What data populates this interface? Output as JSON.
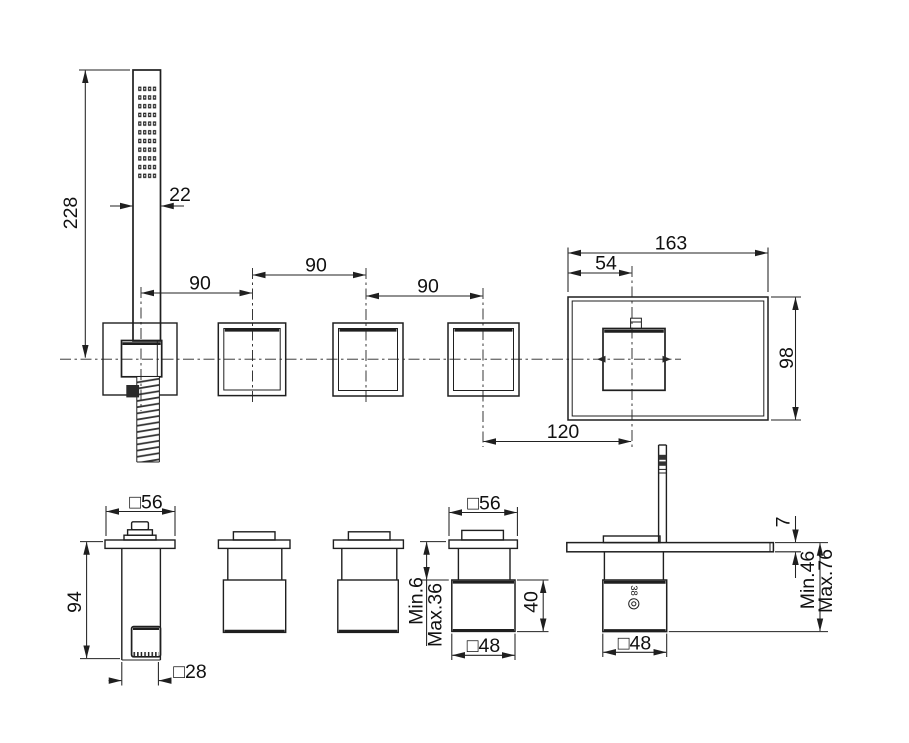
{
  "drawing_type": "faucet-technical-dimension-drawing",
  "colors": {
    "line": "#1f1f1f",
    "text": "#111111",
    "background": "#ffffff"
  },
  "dims": {
    "handshower_length": "228",
    "handshower_width": "22",
    "valve_spacing": "90",
    "plate_width": "163",
    "knob_offset": "54",
    "plate_height": "98",
    "spout_offset": "120",
    "flange_square": "□56",
    "holder_height": "94",
    "outlet_square": "□28",
    "neck_min": "Min.6",
    "neck_max": "Max.36",
    "body_height": "40",
    "body_square": "□48",
    "plate_thickness": "7",
    "mount_min": "Min.46",
    "mount_max": "Max.76",
    "temp_mark": "38"
  }
}
